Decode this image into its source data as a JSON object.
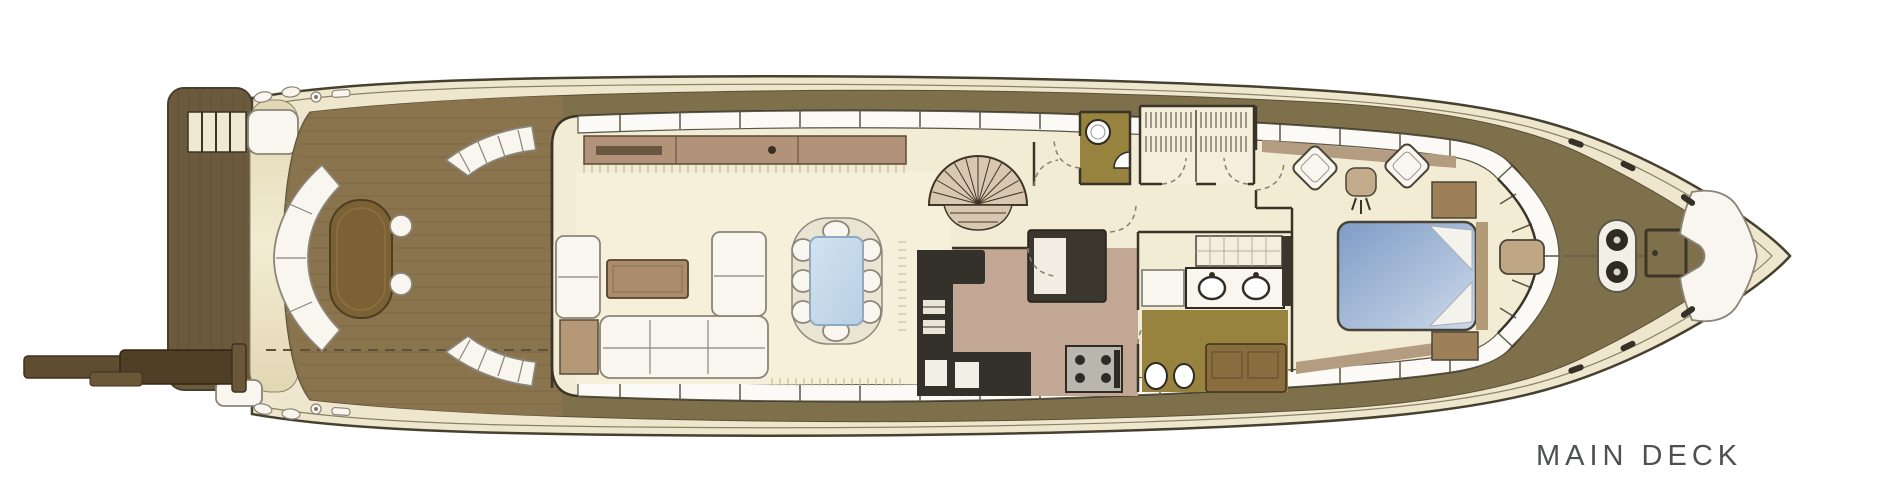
{
  "page": {
    "background_color": "#ffffff"
  },
  "plan": {
    "title": "MAIN DECK",
    "title_color": "#4f5052",
    "palette": {
      "hull_outline": "#46402f",
      "gunwale": "#efe7cd",
      "deck_olive": "#7e704a",
      "teak_deck": "#8a744e",
      "teak_plank": "#6f5c3b",
      "swim_platform": "#6b5a3c",
      "transom_light": "#f3ecd2",
      "transom_dark": "#e2d7b4",
      "interior": "#f3ecd4",
      "carpet": "#f6f0da",
      "furn_white": "#f8f6ee",
      "furn_outline": "#8a8577",
      "wall_dark": "#3a3428",
      "wood_table": "#7c6135",
      "sideboard": "#b2937a",
      "coffee_table": "#ab8c6c",
      "table_blue1": "#d3e3f0",
      "table_blue2": "#b7cfe4",
      "galley_floor": "#c3a795",
      "counter_dark": "#34302a",
      "stove_gray": "#b9b6ae",
      "head_olive": "#97823e",
      "bed_blue1": "#7e9cc6",
      "bed_blue2": "#cdd9e9",
      "nightstand": "#9d8057",
      "window_white": "#fbfaf6",
      "sill_tan": "#b49c80",
      "fringe": "#c9bd97",
      "dash_line": "#5f5138",
      "arc_line": "#8a7f68",
      "title_color": "#4f5052"
    },
    "features": [
      "passerelle",
      "swim-platform",
      "transom-steps",
      "aft-deck",
      "transom-settee",
      "cockpit-table",
      "cockpit-stools",
      "side-boarding-stairs",
      "salon",
      "salon-sofa",
      "coffee-table",
      "sideboard",
      "dining-table",
      "dining-chairs",
      "spiral-staircase",
      "galley",
      "galley-counters",
      "stove",
      "day-head",
      "pantry-closet",
      "master-bathroom",
      "vanity-double-sink",
      "master-cabin",
      "double-bed",
      "armchairs",
      "windshield",
      "foredeck",
      "anchor-windlass",
      "deck-hatch",
      "bow-settee",
      "mooring-cleats"
    ]
  }
}
